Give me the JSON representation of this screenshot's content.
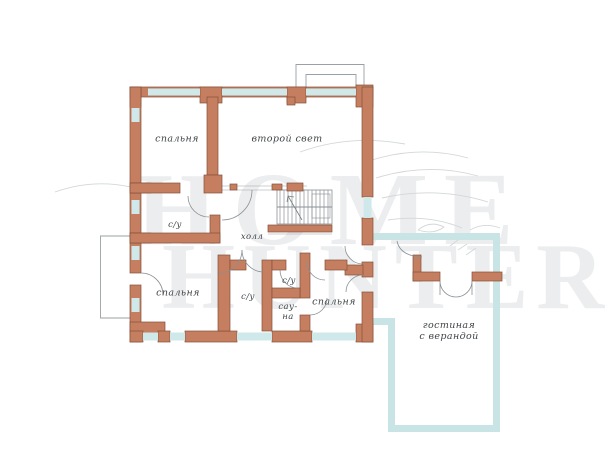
{
  "watermark": {
    "line1": "HOME",
    "line2": "HUNTER"
  },
  "rooms": {
    "bedroom_top": "спальня",
    "second_light": "второй свет",
    "hall": "холл",
    "bathroom_left": "с/у",
    "bedroom_bottom_left": "спальня",
    "bathroom_middle": "с/у",
    "bathroom_small": "с/у",
    "sauna_line1": "сау-",
    "sauna_line2": "на",
    "bedroom_bottom_right": "спальня",
    "living_line1": "гостиная",
    "living_line2": "с верандой"
  },
  "colors": {
    "wall_fill": "#c57e60",
    "wall_outline": "#85503a",
    "window_fill": "#cfe8e9",
    "veranda_border": "#c9e4e5",
    "thin_line": "#8a9094",
    "label_text": "#3f4447",
    "watermark_text": "#9ea4a8"
  }
}
